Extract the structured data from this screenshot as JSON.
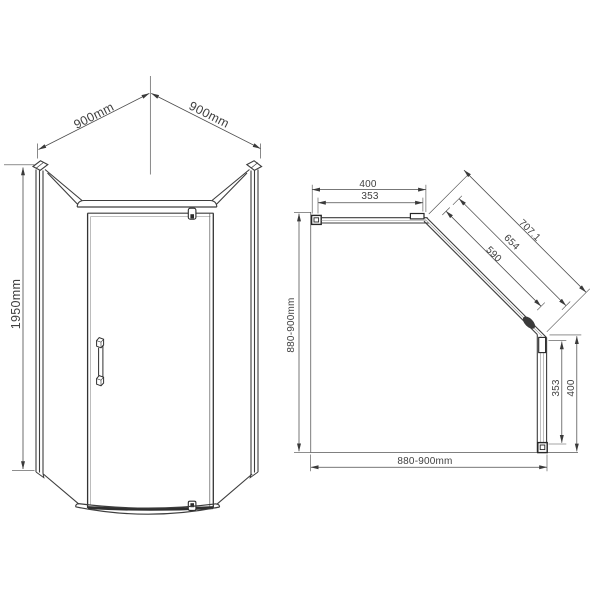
{
  "front": {
    "dim_width_left": "900mm",
    "dim_width_right": "900mm",
    "dim_height": "1950mm"
  },
  "plan": {
    "dim_top_overall": "400",
    "dim_top_glass": "353",
    "dim_door_outer": "707.1",
    "dim_door_frame": "654",
    "dim_door_glass": "590",
    "dim_right_glass": "353",
    "dim_right_overall": "400",
    "dim_left_depth": "880-900mm",
    "dim_bottom_width": "880-900mm"
  },
  "colors": {
    "background": "#ffffff",
    "structure_line": "#3d3d3d",
    "dimension_line": "#4a4a4a",
    "profile_dark": "#262626"
  }
}
